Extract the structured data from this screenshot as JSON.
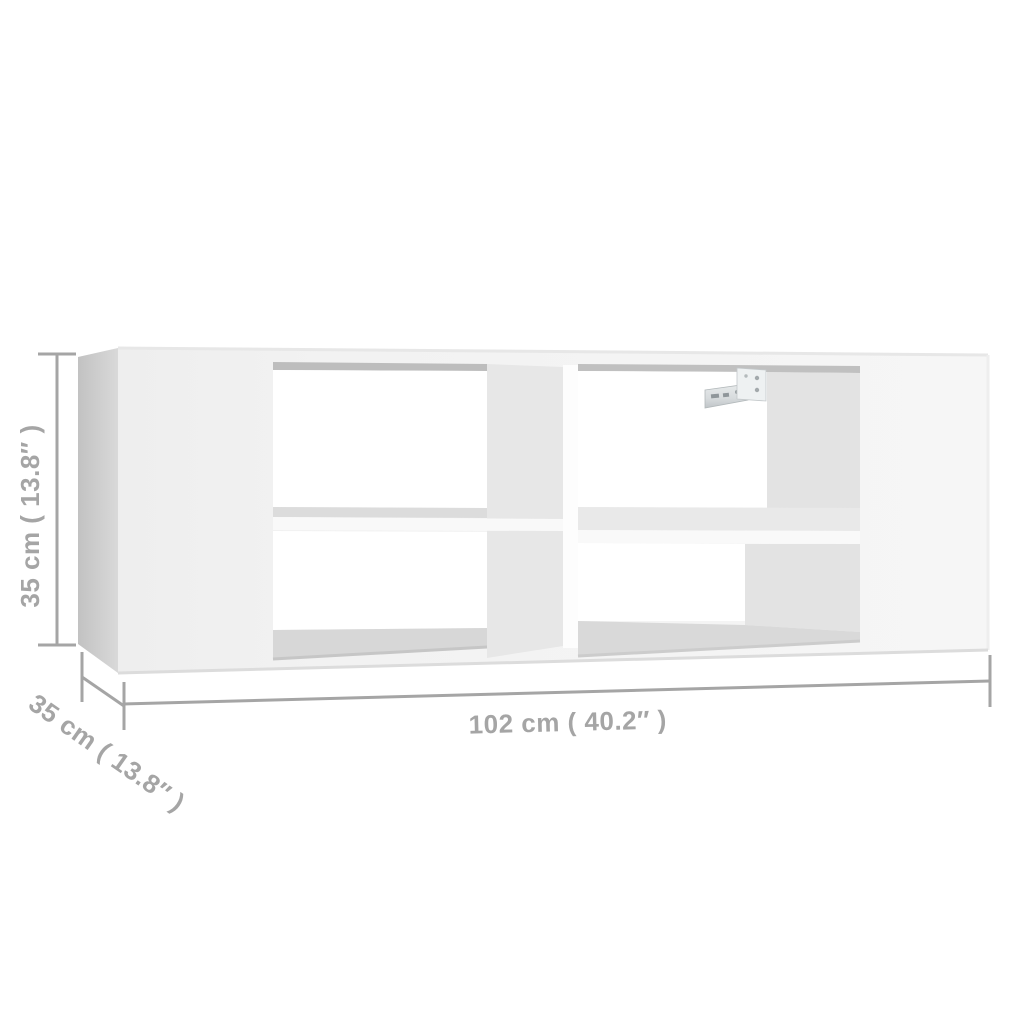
{
  "image": {
    "kind": "product dimension diagram",
    "subject": "wall-mounted TV shelf with four open compartments and metal wall-mount bracket",
    "background": "#ffffff"
  },
  "dimensions": {
    "height": {
      "text": "35 cm ( 13.8″ )",
      "cm": "35",
      "inches": "13.8"
    },
    "depth": {
      "text": "35 cm ( 13.8″ )",
      "cm": "35",
      "inches": "13.8"
    },
    "width": {
      "text": "102 cm ( 40.2″ )",
      "cm": "102",
      "inches": "40.2"
    }
  },
  "colors": {
    "dimension": "#a5a5a5",
    "opening": "#ffffff",
    "interior_shadow": "#e3e3e3",
    "divider_shadow": "#e7e7e7",
    "side_panel": "#c9c9c9",
    "front_panel": "#f2f2f2"
  }
}
